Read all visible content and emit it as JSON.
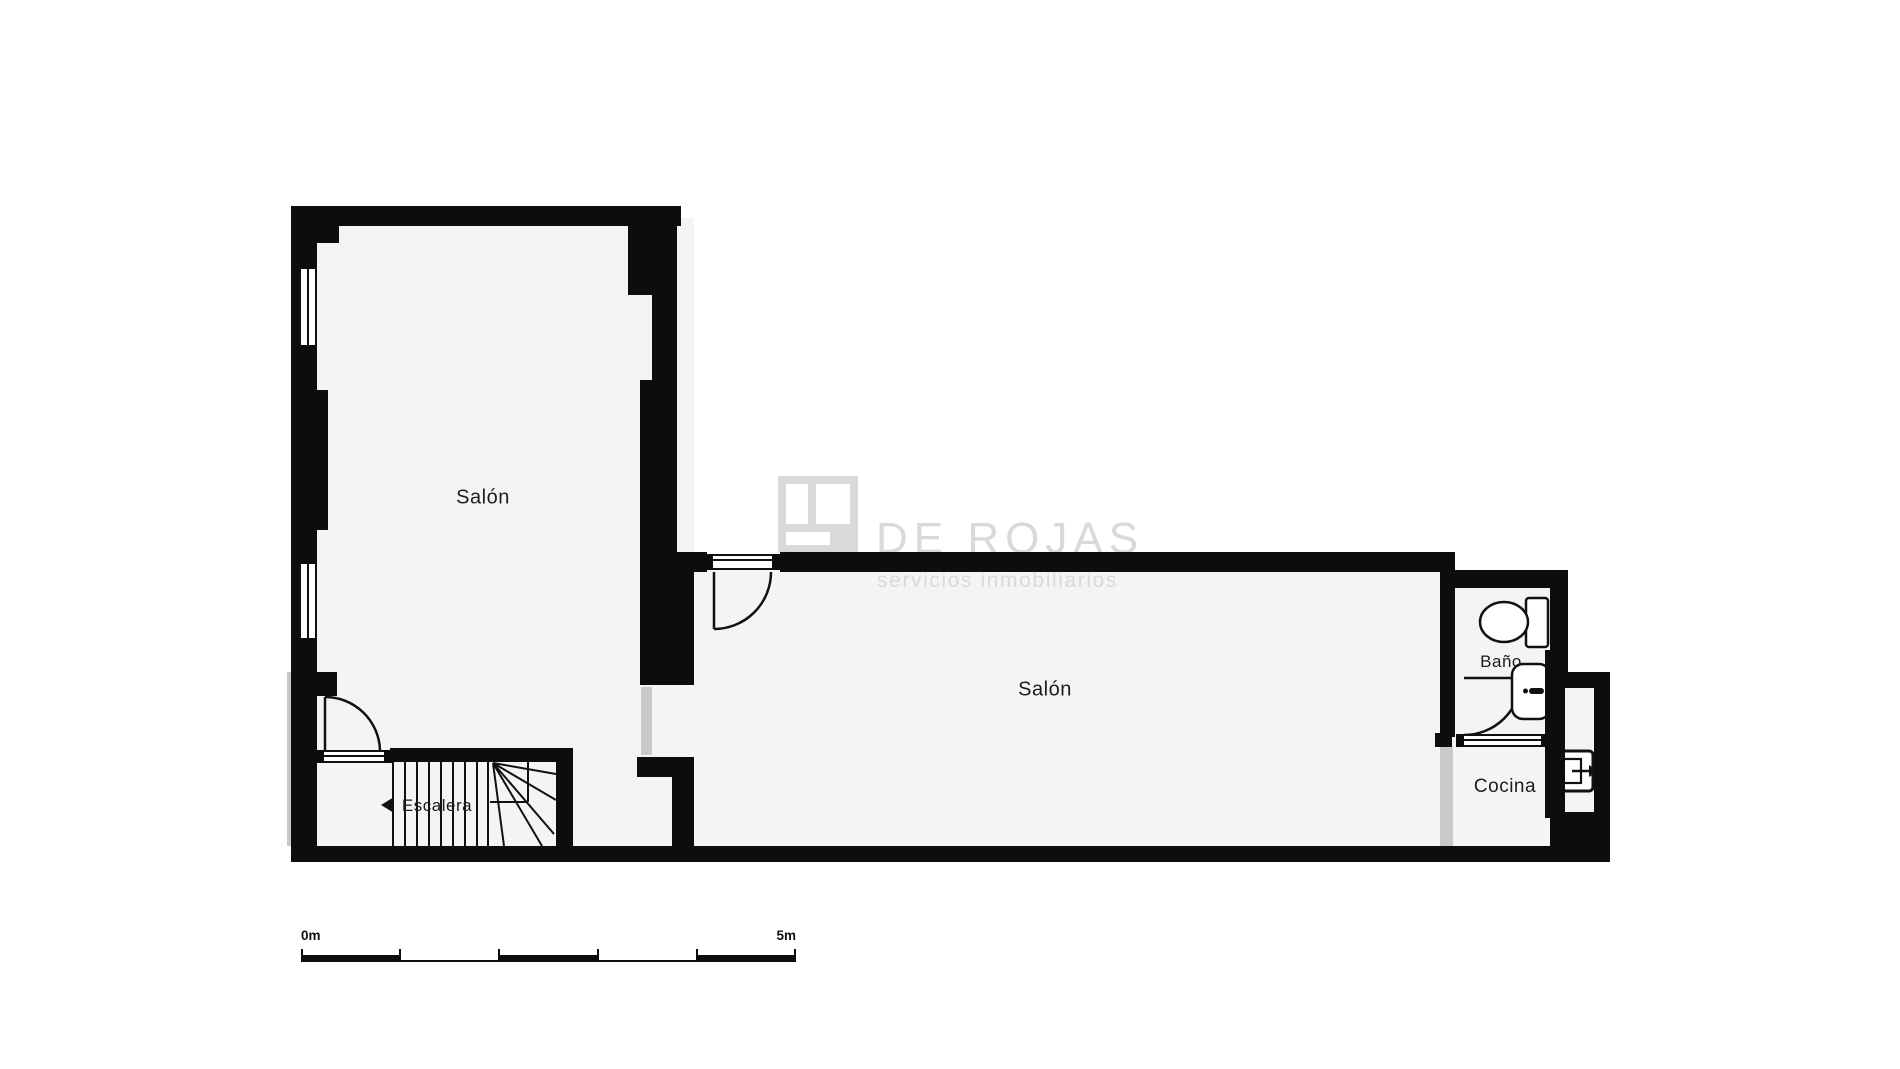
{
  "plan": {
    "room_labels": {
      "salon_top": "Salón",
      "salon_main": "Salón",
      "bathroom": "Baño",
      "kitchen": "Cocina",
      "stairs": "Escalera"
    },
    "watermark": {
      "brand": "DE ROJAS",
      "tagline": "servicios inmobiliarios",
      "logo": "window-logo",
      "color": "#d9d9d9"
    },
    "scale_bar": {
      "start": "0m",
      "end": "5m"
    },
    "colors": {
      "wall": "#0d0d0d",
      "floor": "#f5f4f3",
      "background": "#ffffff",
      "opening": "#c9c9c9",
      "label": "#1c1c1c"
    }
  }
}
